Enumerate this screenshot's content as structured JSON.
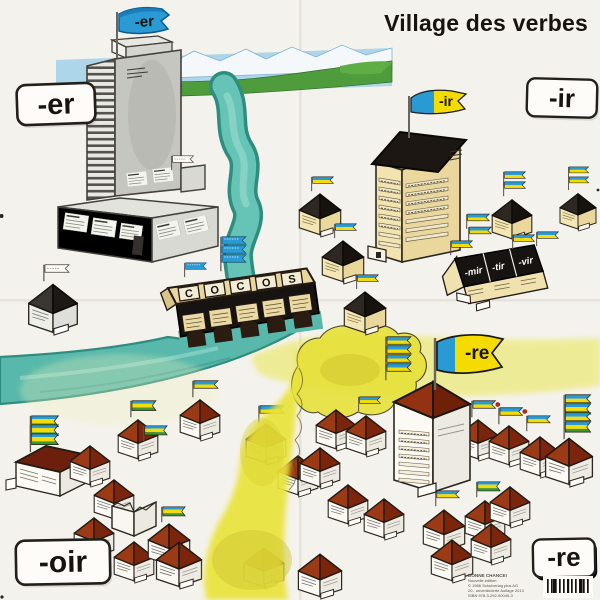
{
  "title": "Village des verbes",
  "corner_labels": {
    "er": "-er",
    "ir": "-ir",
    "oir": "-oir",
    "re": "-re"
  },
  "flags": {
    "er": "-er",
    "ir": "-ir",
    "re": "-re"
  },
  "bridge_letters": [
    "C",
    "O",
    "C",
    "O",
    "S"
  ],
  "row_house_labels": [
    "-mir",
    "-tir",
    "-vir"
  ],
  "publisher": {
    "lines": [
      "BONNE CHANCE!",
      "Nouvelle édition",
      "© 1986 Schulverlag plus AG",
      "20., unveränderte Auflage 2013",
      "ISBN 978-3-292-00045-3"
    ]
  },
  "palette": {
    "paper": "#f4f2ed",
    "river_teal": "#57b8ab",
    "river_edge": "#2f8d80",
    "flag_blue": "#2a9ad4",
    "flag_yellow": "#f5dc00",
    "flag_green": "#3f9630",
    "roof_red": "#9b3a15",
    "roof_maroon": "#6b1f0c",
    "roof_black": "#1c1712",
    "building_tan": "#f0e2ae",
    "building_gray": "#c7c7c1",
    "field_yellow": "#e9e33a",
    "hill_green": "#4f9c3c",
    "sky_blue": "#aed6ea",
    "label_ink": "#15120e"
  }
}
